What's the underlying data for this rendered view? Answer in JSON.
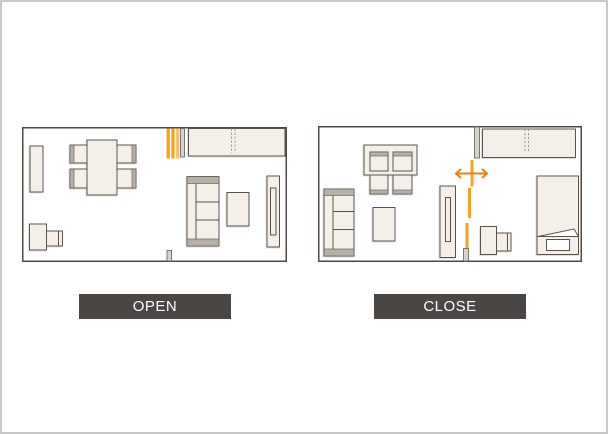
{
  "labels": {
    "open_caption": "OPEN",
    "close_caption": "CLOSE"
  },
  "colors": {
    "canvas_border": "#c8c8c8",
    "wall": "#4e4842",
    "furniture_fill": "#f4f0e9",
    "furniture_stroke": "#5a534c",
    "accent_band": "#b5b0a8",
    "stub_fill": "#d7d3ce",
    "stub_stroke": "#6f6962",
    "door_orange": "#f5a41f",
    "door_orange_light": "#f8c169",
    "arrow_orange": "#e1821f",
    "dashline": "#a29a90",
    "label_bar_bg": "#4a4643",
    "label_text": "#ffffff"
  },
  "plans": {
    "open": {
      "caption": "OPEN",
      "furniture": [
        "shelf-icon",
        "dining-table-icon",
        "dining-chair-icon",
        "partition-panels-stacked-icon",
        "wall-stub-icon",
        "closet-icon",
        "sofa-icon",
        "coffee-table-icon",
        "tv-board-icon",
        "desk-icon",
        "desk-chair-icon",
        "door-stub-icon"
      ]
    },
    "close": {
      "caption": "CLOSE",
      "furniture": [
        "sofa-icon",
        "dining-table-icon",
        "dining-chair-icon",
        "coffee-table-icon",
        "tv-board-icon",
        "wall-stub-icon",
        "partition-line-closed-icon",
        "slide-direction-arrow-icon",
        "closet-icon",
        "bed-icon",
        "pillow-icon",
        "desk-icon",
        "desk-chair-icon",
        "door-stub-icon"
      ]
    }
  }
}
